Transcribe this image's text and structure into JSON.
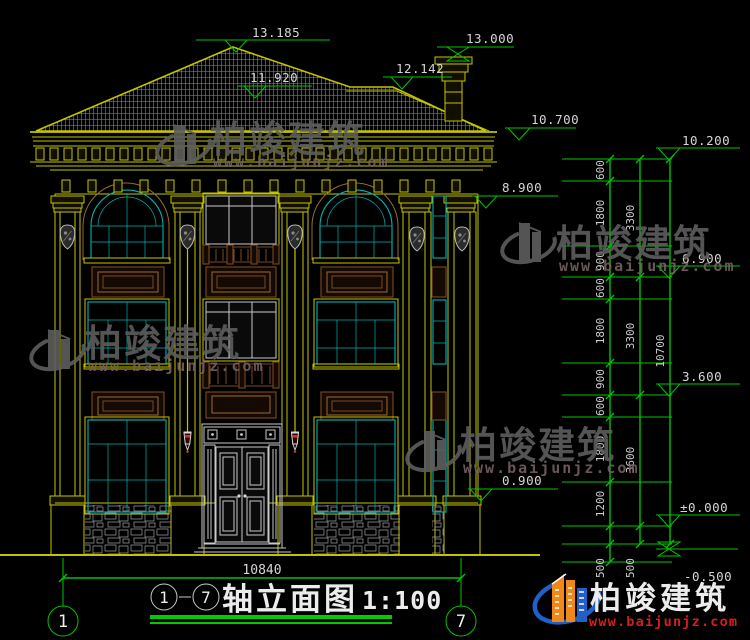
{
  "drawing": {
    "type": "front-elevation",
    "background": "#000000",
    "accent_green": "#00c400",
    "accent_yellow": "#c3c300",
    "accent_cyan": "#00b2b2"
  },
  "levels": {
    "l13185": "13.185",
    "l13000": "13.000",
    "l12142": "12.142",
    "l11920": "11.920",
    "l10700": "10.700",
    "l10200": "10.200",
    "l8900": "8.900",
    "l6900": "6.900",
    "l3600": "3.600",
    "l0900": "0.900",
    "l0": "±0.000",
    "lm05": "-0.500"
  },
  "chain": {
    "c600": "600",
    "c900": "900",
    "c1800": "1800",
    "c1200": "1200",
    "c500": "500",
    "c3300": "3300",
    "c3600": "3600",
    "c10700": "10700",
    "bottom": "10840"
  },
  "axes": {
    "a1": "1",
    "a7": "7"
  },
  "title": {
    "axis1": "1",
    "dash": "—",
    "axis7": "7",
    "name": "轴立面图",
    "scale": "1:100"
  },
  "brand": {
    "name": "柏竣建筑",
    "url": "www.baijunjz.com"
  }
}
